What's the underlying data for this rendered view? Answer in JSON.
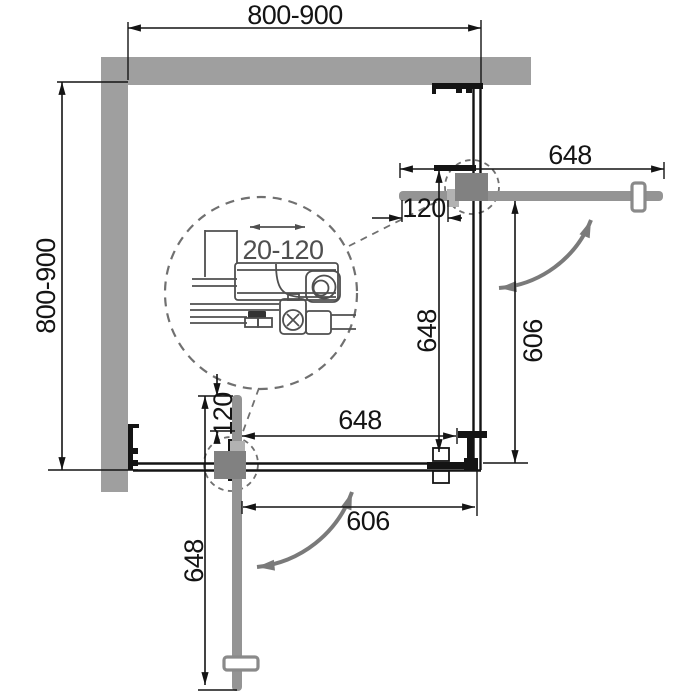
{
  "drawing": {
    "dimensions": {
      "overall_width_top": "800-900",
      "overall_depth_left": "800-900",
      "right_door_open_width": "648",
      "right_wall_profile_adjust": "120",
      "right_side_door_width": "648",
      "right_entry_width": "606",
      "bottom_side_door_width": "648",
      "bottom_wall_profile_adjust": "120",
      "bottom_door_open_width": "648",
      "bottom_entry_width": "606",
      "detail_adjust_range": "20-120"
    },
    "colors": {
      "wall": "#9f9f9f",
      "door": "#949494",
      "hinge": "#818181",
      "hinge_tab": "#b2b2b2",
      "handle": "#8a8a8a",
      "line": "#141414",
      "detail": "#4f4f4f",
      "arc": "#7a7a7a",
      "dash": "#707070"
    }
  }
}
